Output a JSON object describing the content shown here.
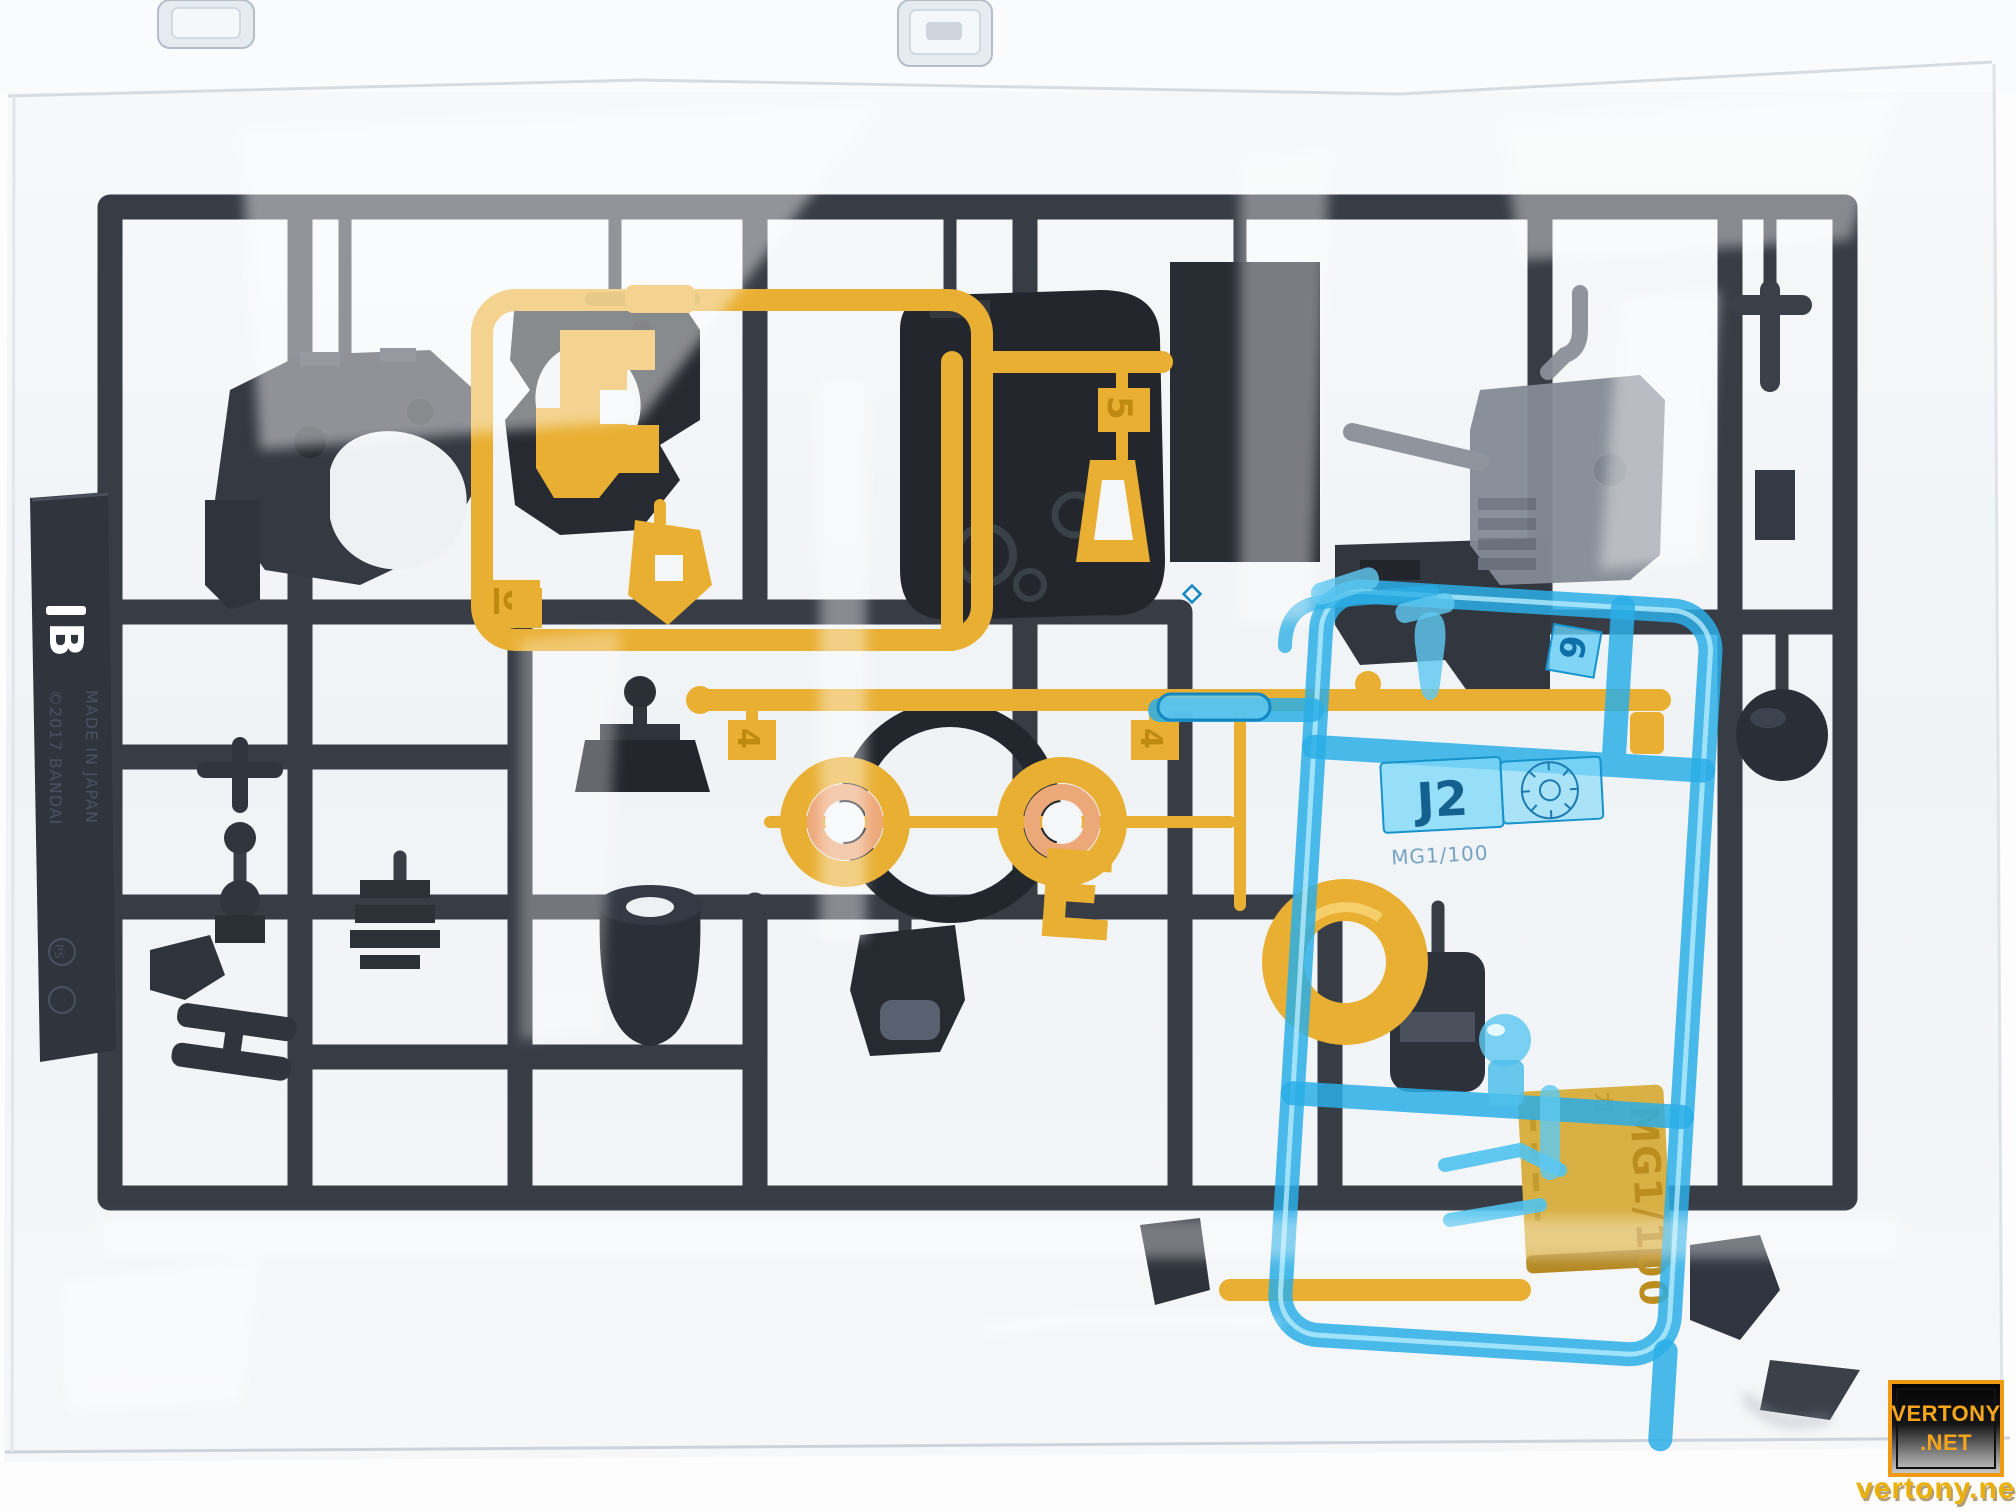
{
  "runner_marks": {
    "black_runner_letter": "B",
    "copyright_line1": "©2017 BANDAI",
    "copyright_line2": "MADE IN JAPAN",
    "material_code": "PS",
    "yellow_gate_6": "6",
    "yellow_gate_5": "5",
    "yellow_gate_4a": "4",
    "yellow_gate_4b": "4",
    "blue_gate_6": "6",
    "blue_runner_code": "J2",
    "blue_scale_text": "MG1/100",
    "gold_tag_scale_text": "MG1/100",
    "gold_tag_kana": "ガ"
  },
  "watermark": {
    "badge_line1": "VERTONY",
    "badge_line2": ".NET",
    "site_text": "vertony.net"
  },
  "colors": {
    "bag": "#f2f4f6",
    "black_runner": "#373c45",
    "yellow_runner": "#e9af33",
    "blue_runner": "#2aaee6",
    "gold_tag": "#d9b044",
    "orange_bushing": "#eda879",
    "watermark_orange": "#f5a41a"
  }
}
